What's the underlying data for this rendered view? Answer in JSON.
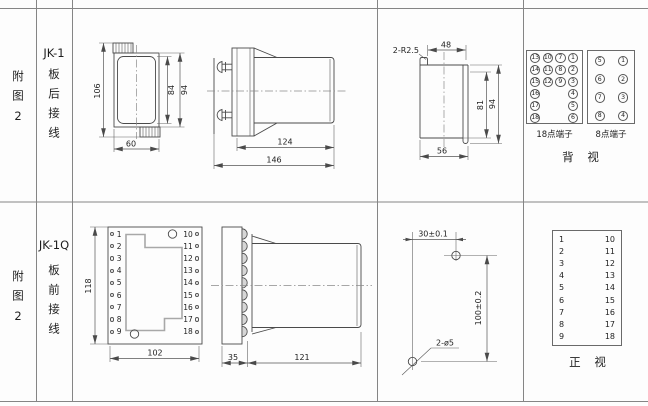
{
  "row1": {
    "figure": "附图2",
    "model": "JK-1",
    "wiring": "板后接线",
    "dims": {
      "w106": "106",
      "w84": "84",
      "w94": "94",
      "w60": "60",
      "l124": "124",
      "l146": "146",
      "radius": "2-R2.5",
      "w48": "48",
      "h81": "81",
      "h94": "94",
      "w56": "56"
    },
    "terminals18": {
      "caption": "18点端子",
      "cells": [
        "13",
        "10",
        "7",
        "1",
        "14",
        "11",
        "8",
        "2",
        "15",
        "12",
        "9",
        "3",
        "16",
        "",
        "",
        "4",
        "17",
        "",
        "",
        "5",
        "18",
        "",
        "",
        "6"
      ]
    },
    "terminals8": {
      "caption": "8点端子",
      "cells": [
        "5",
        "1",
        "6",
        "2",
        "7",
        "3",
        "8",
        "4"
      ]
    },
    "view_label": "背 视"
  },
  "row2": {
    "figure": "附图2",
    "model": "JK-1Q",
    "wiring": "板前接线",
    "dims": {
      "h118": "118",
      "w102": "102",
      "d35": "35",
      "l121": "121",
      "span30": "30±0.1",
      "span100": "100±0.2",
      "holes": "2-ø5"
    },
    "front_view": {
      "left": [
        "1",
        "2",
        "3",
        "4",
        "5",
        "6",
        "7",
        "8",
        "9"
      ],
      "right": [
        "10",
        "11",
        "12",
        "13",
        "14",
        "15",
        "16",
        "17",
        "18"
      ]
    },
    "terminal_table": {
      "rows": [
        {
          "l": "1",
          "r": "10"
        },
        {
          "l": "2",
          "r": "11"
        },
        {
          "l": "3",
          "r": "12"
        },
        {
          "l": "4",
          "r": "13"
        },
        {
          "l": "5",
          "r": "14"
        },
        {
          "l": "6",
          "r": "15"
        },
        {
          "l": "7",
          "r": "16"
        },
        {
          "l": "8",
          "r": "17"
        },
        {
          "l": "9",
          "r": "18"
        }
      ]
    },
    "view_label": "正 视"
  }
}
